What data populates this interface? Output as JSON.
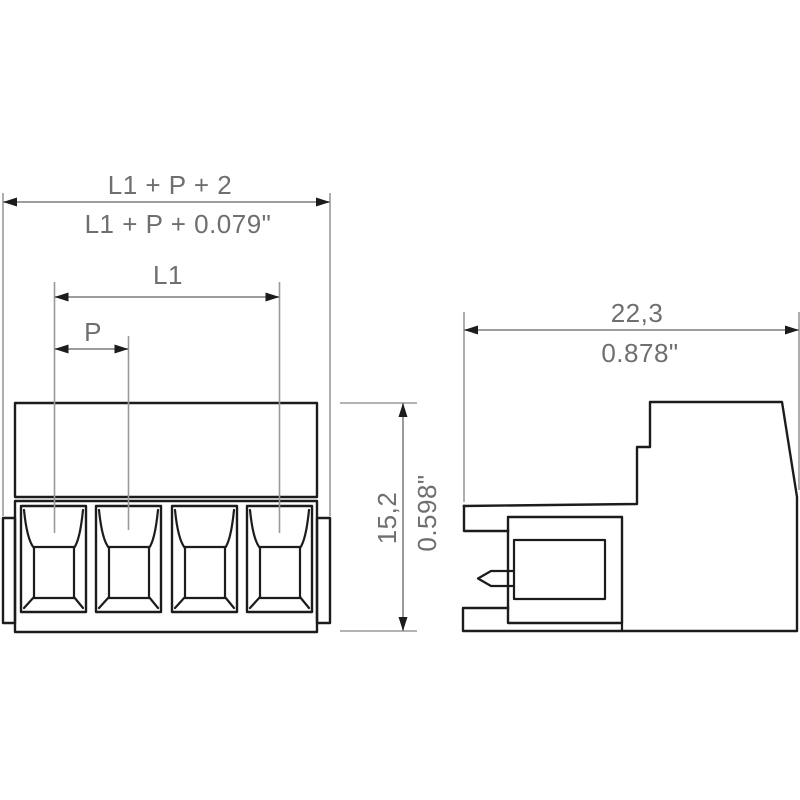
{
  "drawing": {
    "title": "terminal-block-dimension-drawing",
    "pole_count": 4,
    "front_view": {
      "dim_overall_metric": "L1 + P + 2",
      "dim_overall_imperial": "L1 + P + 0.079\"",
      "dim_l1_label": "L1",
      "dim_pitch_label": "P",
      "dim_height_metric": "15,2",
      "dim_height_imperial": "0.598\""
    },
    "side_view": {
      "dim_width_metric": "22,3",
      "dim_width_imperial": "0.878\""
    },
    "colors": {
      "background": "#ffffff",
      "body_line": "#1c1c1c",
      "dimension_line": "#8f8f8f",
      "dimension_text": "#6f6f6f"
    }
  }
}
